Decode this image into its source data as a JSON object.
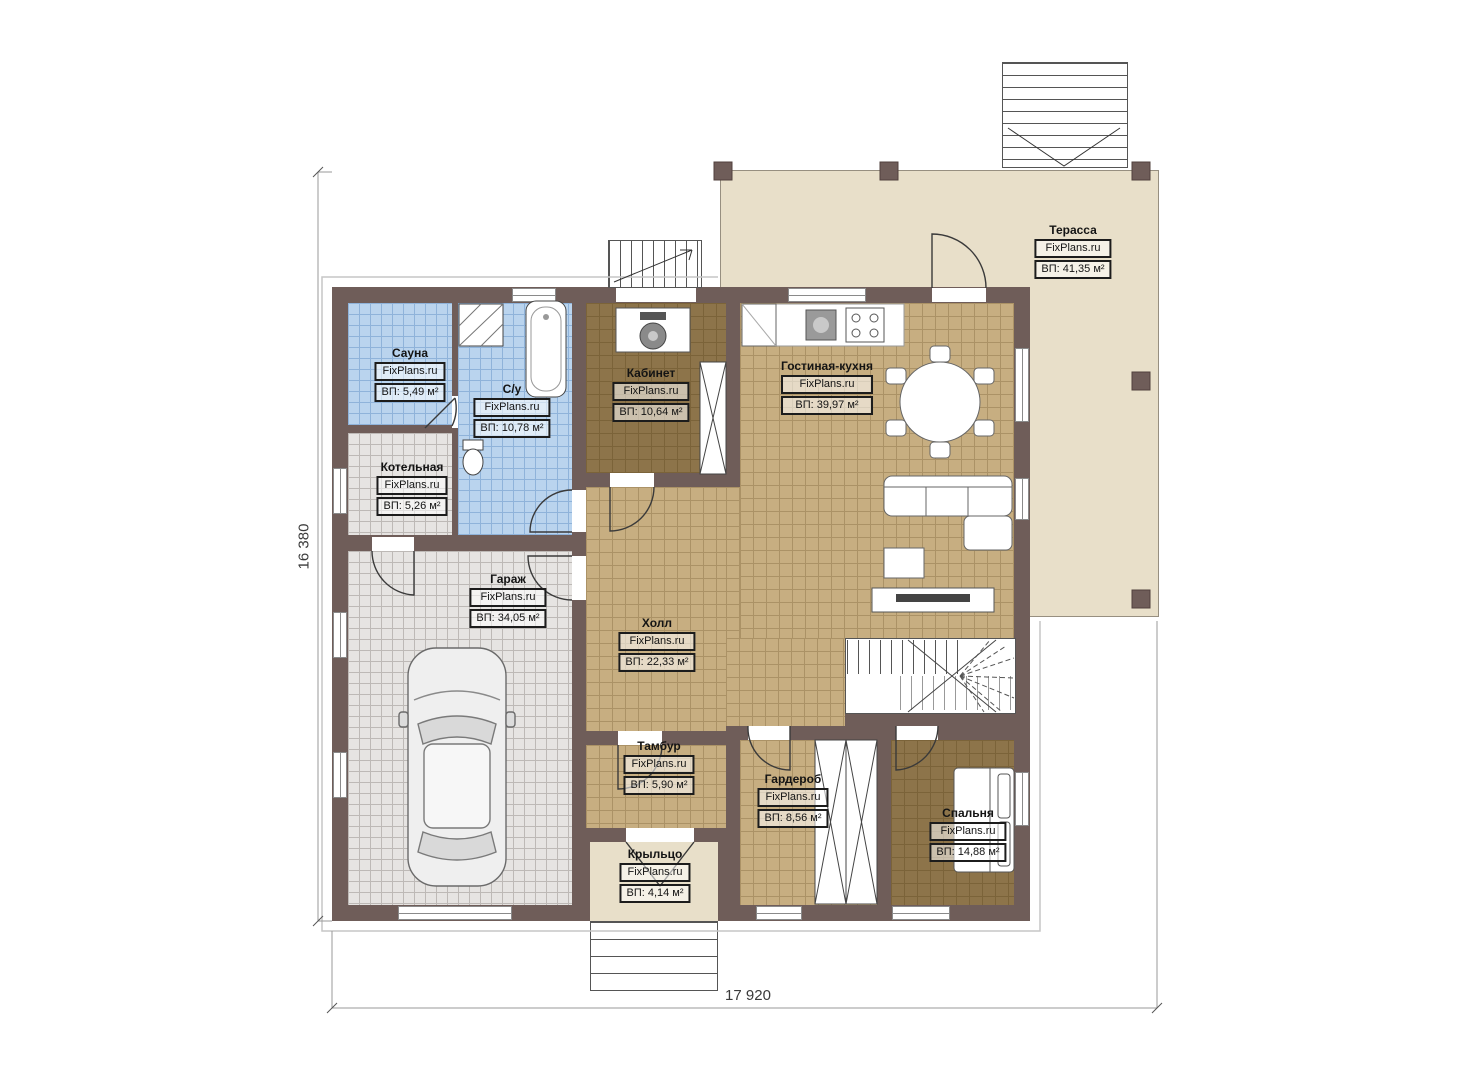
{
  "plan": {
    "watermark": "FixPlans.ru",
    "dimensions": {
      "width": "17 920",
      "height": "16 380"
    },
    "colors": {
      "wall": "#6f5d59",
      "tile_blue": "#bad4ee",
      "tile_gray": "#e6e4e2",
      "tile_tan": "#c7ae81",
      "floor_brown": "#8d744a",
      "terrace": "#e8dfc9"
    },
    "rooms": [
      {
        "id": "sauna",
        "name": "Сауна",
        "site": "FixPlans.ru",
        "area": "ВП: 5,49 м²"
      },
      {
        "id": "bathroom",
        "name": "С/у",
        "site": "FixPlans.ru",
        "area": "ВП: 10,78 м²"
      },
      {
        "id": "boiler",
        "name": "Котельная",
        "site": "FixPlans.ru",
        "area": "ВП: 5,26 м²"
      },
      {
        "id": "garage",
        "name": "Гараж",
        "site": "FixPlans.ru",
        "area": "ВП: 34,05 м²"
      },
      {
        "id": "office",
        "name": "Кабинет",
        "site": "FixPlans.ru",
        "area": "ВП: 10,64 м²"
      },
      {
        "id": "living-kitchen",
        "name": "Гостиная-кухня",
        "site": "FixPlans.ru",
        "area": "ВП: 39,97 м²"
      },
      {
        "id": "hall",
        "name": "Холл",
        "site": "FixPlans.ru",
        "area": "ВП: 22,33 м²"
      },
      {
        "id": "vestibule",
        "name": "Тамбур",
        "site": "FixPlans.ru",
        "area": "ВП: 5,90 м²"
      },
      {
        "id": "wardrobe",
        "name": "Гардероб",
        "site": "FixPlans.ru",
        "area": "ВП: 8,56 м²"
      },
      {
        "id": "bedroom",
        "name": "Спальня",
        "site": "FixPlans.ru",
        "area": "ВП: 14,88 м²"
      },
      {
        "id": "porch",
        "name": "Крыльцо",
        "site": "FixPlans.ru",
        "area": "ВП: 4,14 м²"
      },
      {
        "id": "terrace",
        "name": "Терасса",
        "site": "FixPlans.ru",
        "area": "ВП: 41,35 м²"
      }
    ]
  }
}
